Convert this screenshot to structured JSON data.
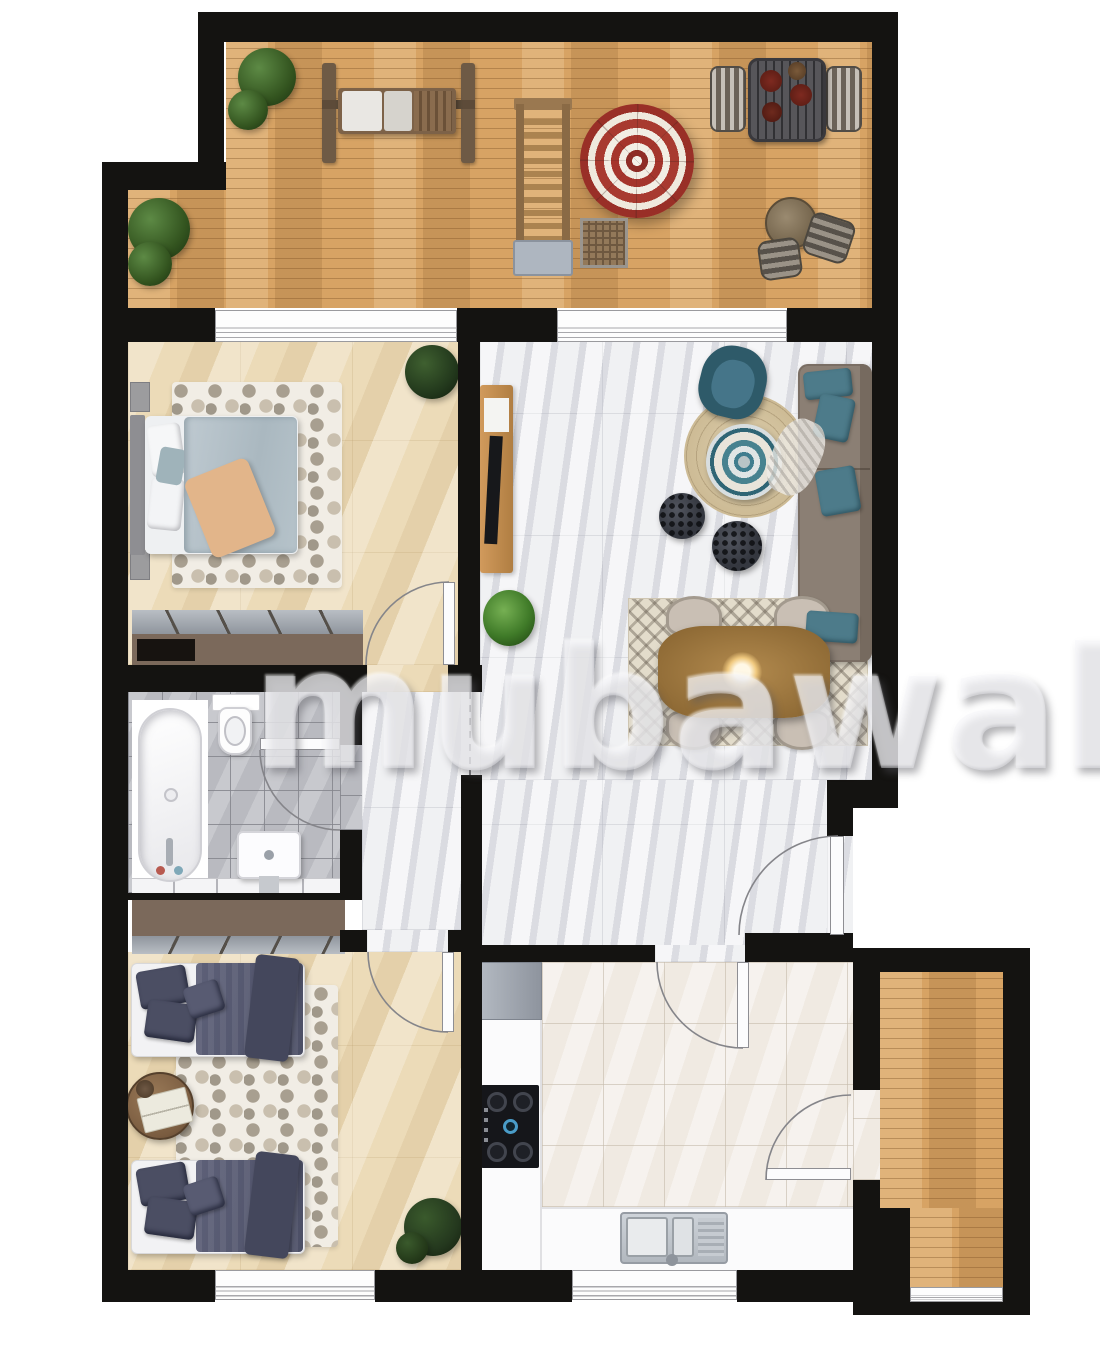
{
  "watermark": {
    "text": "mubawab"
  },
  "palette": {
    "bg": "#ffffff",
    "wall": "#141311",
    "wood": "#d7a364",
    "stone": "#ecdbb8",
    "marble": "#ebecef",
    "bath-tile": "#b9bac0",
    "kitchen-tile": "#f0eae2",
    "counter": "#fbfbfc",
    "rug-cream": "#f1ede5",
    "accent-teal": "#4d7b8a",
    "sofa-brown": "#8b7f74",
    "bed-navy": "#53566c",
    "bed-blue": "#b6c3ca",
    "wardrobe-brown": "#7b695b",
    "umbrella-red": "#a0332b",
    "plant-green": "#35571f",
    "door-arc": "#85858a"
  },
  "rooms": [
    {
      "id": "terrace",
      "floor": "wood-deck",
      "furniture": [
        "shrub",
        "shrub",
        "garden-swing",
        "sun-lounger",
        "parasol",
        "wicker-side-table",
        "outdoor-dining-table",
        "outdoor-chair",
        "outdoor-chair",
        "bistro-table",
        "stool",
        "stool"
      ]
    },
    {
      "id": "bedroom-1",
      "floor": "beige-stone-tile",
      "furniture": [
        "double-bed",
        "nightstand",
        "nightstand",
        "hex-rug",
        "potted-plant",
        "built-in-wardrobe"
      ]
    },
    {
      "id": "living-dining",
      "floor": "white-marble-tile",
      "furniture": [
        "tv-sideboard",
        "tv",
        "armchair",
        "round-jute-rug",
        "mandala-coffee-table",
        "pouf",
        "pouf",
        "sofa",
        "throw-blanket",
        "dining-rug",
        "dining-table",
        "dining-chair",
        "dining-chair",
        "dining-chair",
        "dining-chair",
        "pendant-lamp",
        "potted-plant"
      ]
    },
    {
      "id": "bathroom",
      "floor": "grey-tile",
      "furniture": [
        "bathtub",
        "toilet",
        "washbasin",
        "shelf-strip"
      ]
    },
    {
      "id": "hallway",
      "floor": "white-marble-tile",
      "furniture": []
    },
    {
      "id": "bedroom-2",
      "floor": "beige-stone-tile",
      "furniture": [
        "single-bed",
        "single-bed",
        "round-side-table",
        "books",
        "hex-rug",
        "potted-plant",
        "built-in-wardrobe"
      ]
    },
    {
      "id": "kitchen",
      "floor": "cream-tile",
      "furniture": [
        "fridge",
        "counter",
        "gas-cooktop",
        "double-sink"
      ]
    },
    {
      "id": "balcony",
      "floor": "wood-deck",
      "furniture": []
    }
  ],
  "openings": [
    "window-bedroom-1",
    "window-living",
    "window-bedroom-2",
    "window-kitchen",
    "window-balcony",
    "door-bedroom-1",
    "door-bathroom",
    "door-bedroom-2",
    "door-kitchen",
    "door-entrance",
    "door-balcony"
  ]
}
